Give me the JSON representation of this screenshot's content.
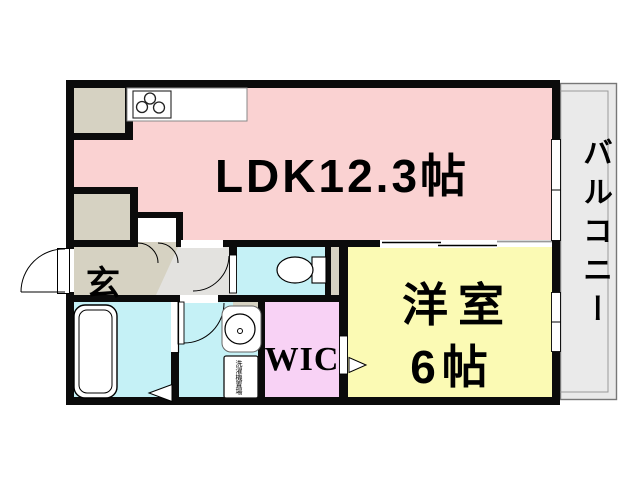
{
  "floorplan": {
    "labels": {
      "ldk": "LDK12.3帖",
      "western_room_line1": "洋室",
      "western_room_line2": "6帖",
      "wic": "WIC",
      "genkan": "玄",
      "balcony": "バルコニー",
      "washer": "洗濯機置場"
    },
    "colors": {
      "wall": "#0b0b0b",
      "ldk": "#fad2d2",
      "western_room": "#fbfab4",
      "wic": "#f8d2f5",
      "wet_area": "#c5f1f6",
      "genkan": "#d6d2c2",
      "hallway": "#e3e2df",
      "balcony": "#eaeaea",
      "fixture": "#ffffff"
    }
  }
}
